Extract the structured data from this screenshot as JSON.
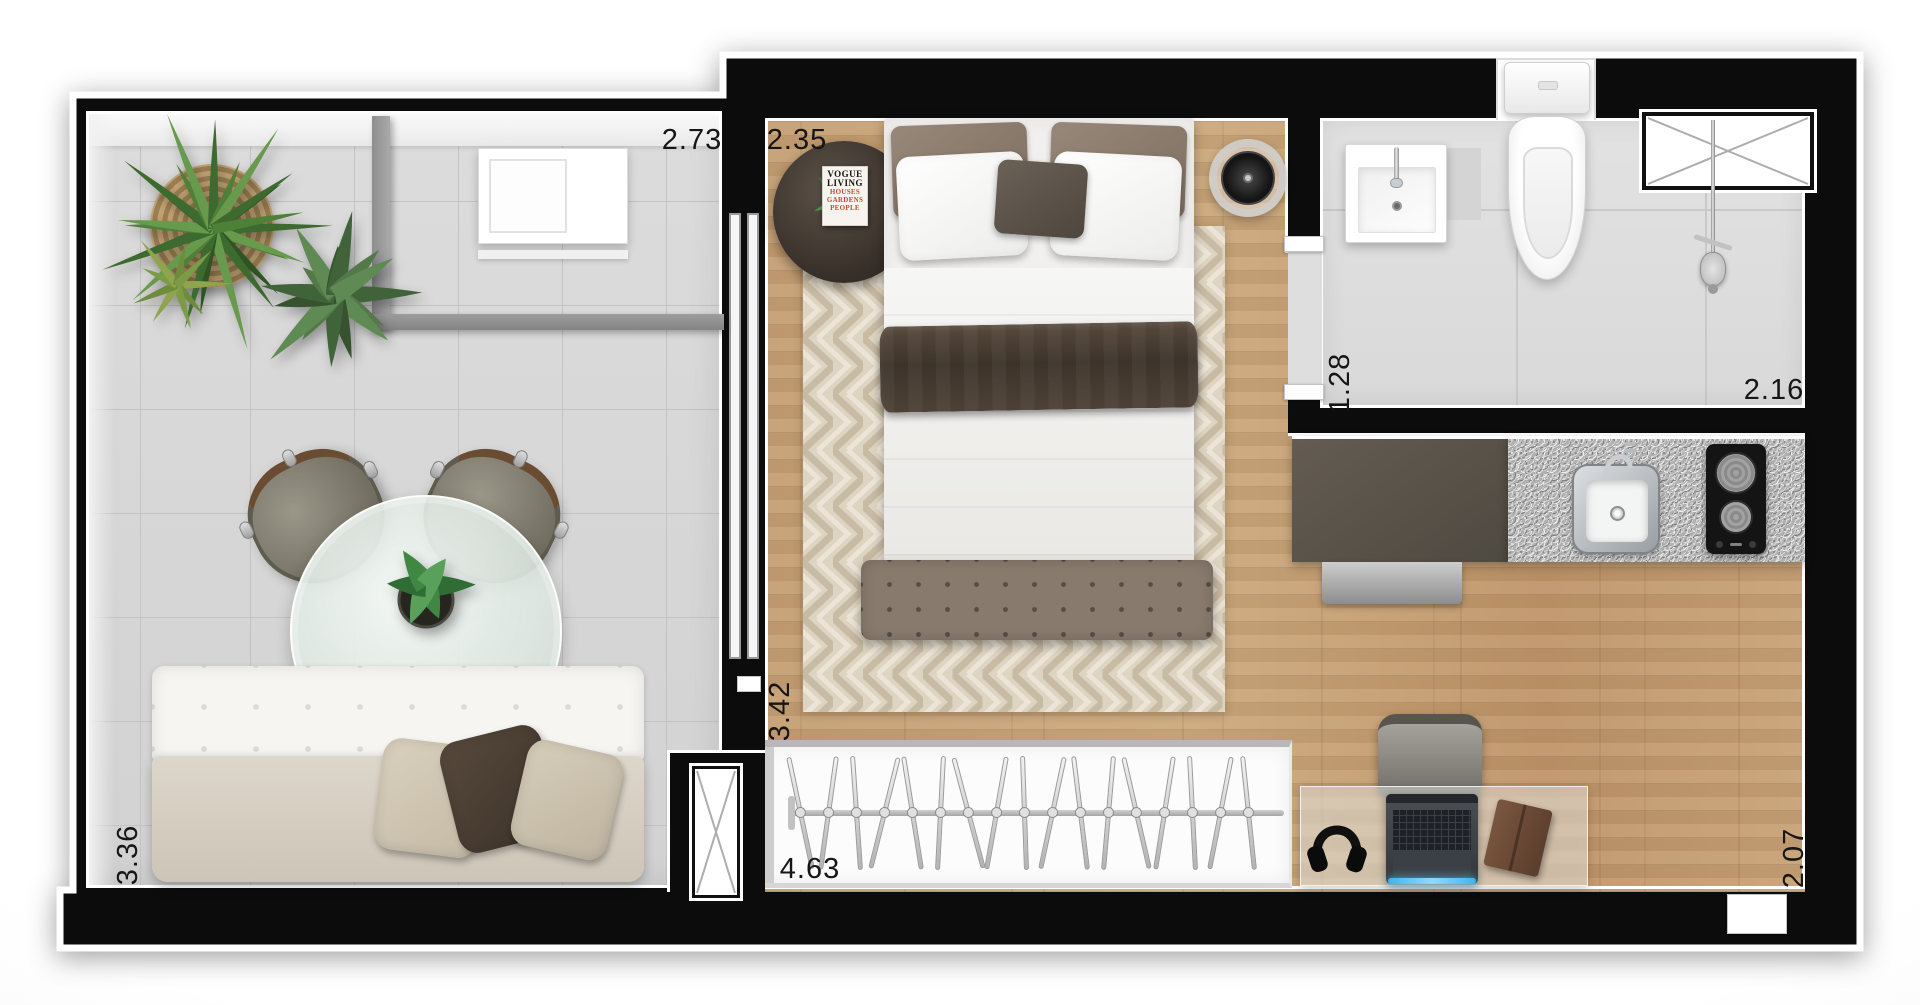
{
  "plan_type": "studio-apartment-floor-plan",
  "dimensions": {
    "balcony_width": "2.73",
    "bedroom_width": "2.35",
    "bath_entry_depth": "1.28",
    "bathroom_width": "2.16",
    "balcony_depth": "3.36",
    "bedroom_depth": "3.42",
    "closet_width": "4.63",
    "living_depth": "2.07"
  },
  "magazine_cover": {
    "line1": "VOGUE",
    "line2": "LIVING",
    "line3": "HOUSES",
    "line4": "GARDENS",
    "line5": "PEOPLE"
  },
  "counts": {
    "closet_hangers": 17,
    "dining_chairs": 2,
    "cooktop_burners": 2,
    "bed_pillows": 5,
    "sofa_pillows": 3
  },
  "palette": {
    "wall": "#0c0c0c",
    "wood_floor": "#c59e72",
    "balcony_tile": "#d6d6d6",
    "bath_tile": "#dedede",
    "granite": "#b0b0b0",
    "rug_base": "#ded4c2",
    "throw_blanket": "#47392c",
    "plant_green": "#4f8038",
    "laptop_glow": "#58c2f5"
  }
}
